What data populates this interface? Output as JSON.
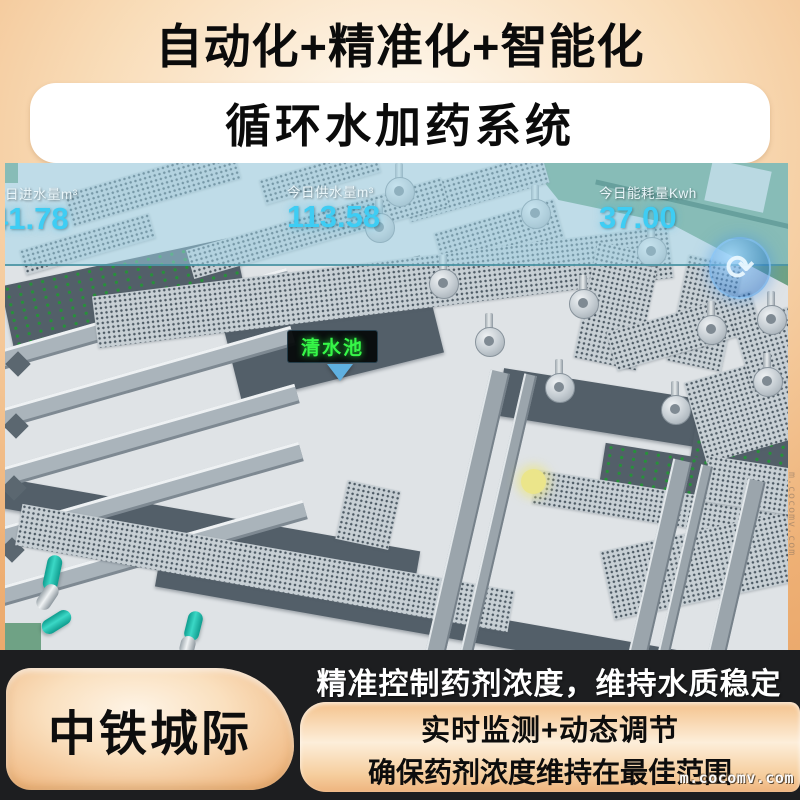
{
  "header": {
    "title_line1": "自动化+精准化+智能化",
    "title_line2": "循环水加药系统"
  },
  "hud": {
    "stats": [
      {
        "label": "今日进水量m³",
        "value": "41.78"
      },
      {
        "label": "今日供水量m³",
        "value": "113.58"
      },
      {
        "label": "今日能耗量Kwh",
        "value": "37.00"
      }
    ],
    "pool_tag": "清水池",
    "compass_glyph": "⟳"
  },
  "footer": {
    "brand": "中铁城际",
    "headline": "精准控制药剂浓度，维持水质稳定",
    "line1": "实时监测+动态调节",
    "line2": "确保药剂浓度维持在最佳范围",
    "watermark": "m.cocomv.com",
    "side_watermark": "m.cocomv.com"
  },
  "colors": {
    "accent_cyan": "#3ecdf4",
    "tag_green": "#36f748",
    "pipe_teal": "#1fbfae",
    "panel_orange": "#f5c28c",
    "grass_green": "#6fa285",
    "footer_black": "#1d1e20"
  }
}
